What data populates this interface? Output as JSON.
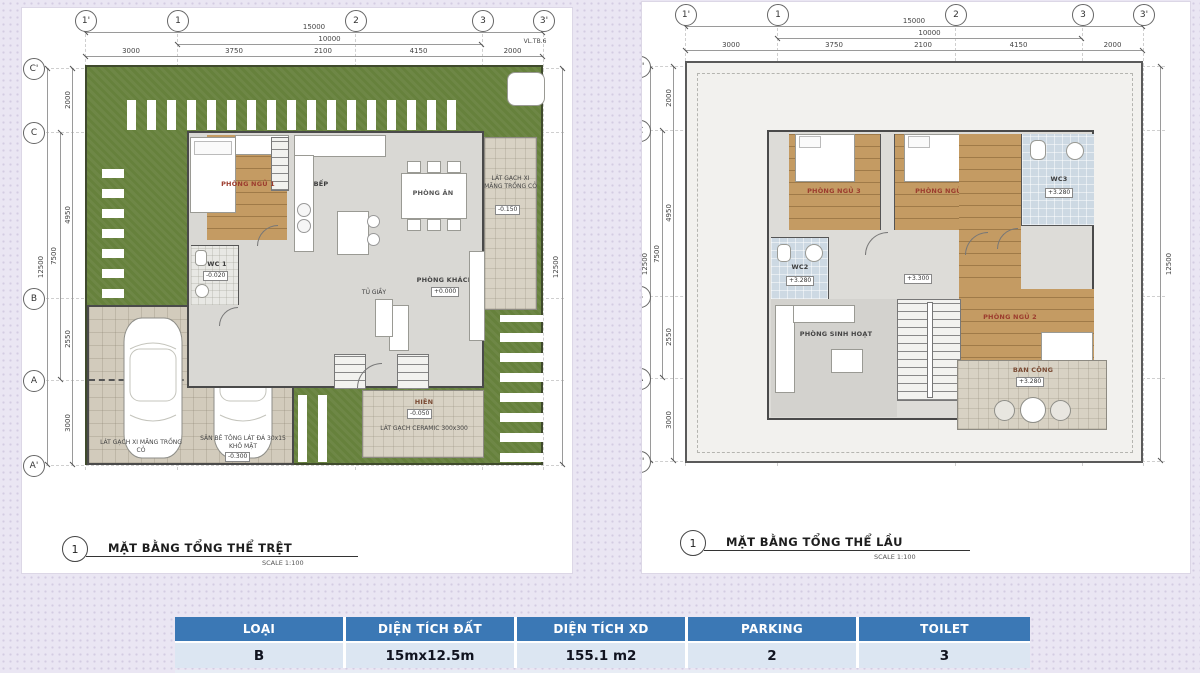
{
  "grid": {
    "top": [
      "1'",
      "1",
      "2",
      "3",
      "3'"
    ],
    "left": [
      "C'",
      "C",
      "B",
      "A",
      "A'"
    ]
  },
  "dims": {
    "top_total": "15000",
    "top_inner": "10000",
    "top_segments": [
      "3000",
      "3750",
      "2100",
      "4150",
      "2000"
    ],
    "left_total": "12500",
    "left_inner": "7500",
    "left_segments": [
      "2000",
      "4950",
      "2550",
      "3000"
    ],
    "side_total": "12500"
  },
  "ground": {
    "ref": "1",
    "title": "MẶT BẰNG TỔNG THỂ TRỆT",
    "scale": "SCALE 1:100",
    "rooms": {
      "bedroom1": "PHÒNG NGỦ 1",
      "kitchen": "BẾP",
      "dining": "PHÒNG ĂN",
      "living": "PHÒNG KHÁCH",
      "living_elev": "+0.000",
      "wc": "WC 1",
      "wc_elev": "-0.020",
      "shoe_cabinet": "TỦ GIẦY",
      "porch": "HIÊN",
      "porch_elev": "-0.050",
      "porch_finish": "LÁT GẠCH CERAMIC 300x300",
      "patio_finish": "LÁT GẠCH XI MĂNG TRỒNG CỎ",
      "patio_elev": "-0.150",
      "garage_finish_left": "LÁT GẠCH XI MĂNG TRỒNG CỎ",
      "garage_finish_right": "SÂN BÊ TÔNG LÁT ĐÁ 30x15 KHÔ MẶT",
      "garage_elev": "-0.300",
      "note_tag": "VL.TB.6"
    }
  },
  "upper": {
    "ref": "1",
    "title": "MẶT BẰNG TỔNG THỂ LẦU",
    "scale": "SCALE 1:100",
    "rooms": {
      "bedroom3": "PHÒNG NGỦ 3",
      "bedroom4": "PHÒNG NGỦ 4",
      "bedroom2": "PHÒNG NGỦ 2",
      "wc2": "WC2",
      "wc2_elev": "+3.280",
      "wc3": "WC3",
      "wc3_elev": "+3.280",
      "hall_elev": "+3.300",
      "family": "PHÒNG SINH HOẠT",
      "balcony": "BAN CÔNG",
      "balcony_elev": "+3.280"
    }
  },
  "table": {
    "headers": [
      "LOẠI",
      "DIỆN TÍCH ĐẤT",
      "DIỆN TÍCH XD",
      "PARKING",
      "TOILET"
    ],
    "row": [
      "B",
      "15mx12.5m",
      "155.1 m2",
      "2",
      "3"
    ]
  }
}
